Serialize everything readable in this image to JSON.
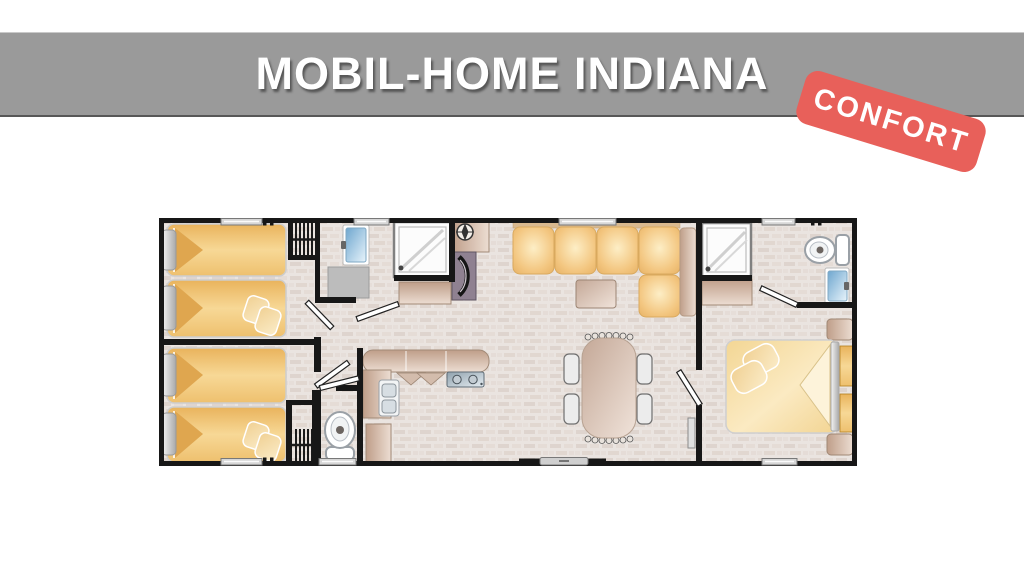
{
  "header": {
    "title": "MOBIL-HOME INDIANA"
  },
  "badge": {
    "label": "CONFORT"
  },
  "colors": {
    "header_background": "#9a9a9a",
    "header_border_bottom": "#575757",
    "title_text": "#ffffff",
    "badge_background": "#e8605a",
    "badge_text": "#ffffff",
    "wall": "#171717",
    "floor_base": "#eae4e0",
    "bed_orange": "#f0c06e",
    "sofa_orange": "#f3c987",
    "furniture_tan": "#d7bfb0",
    "fixture_blue": "#8fbcd8",
    "page_background": "#ffffff"
  }
}
